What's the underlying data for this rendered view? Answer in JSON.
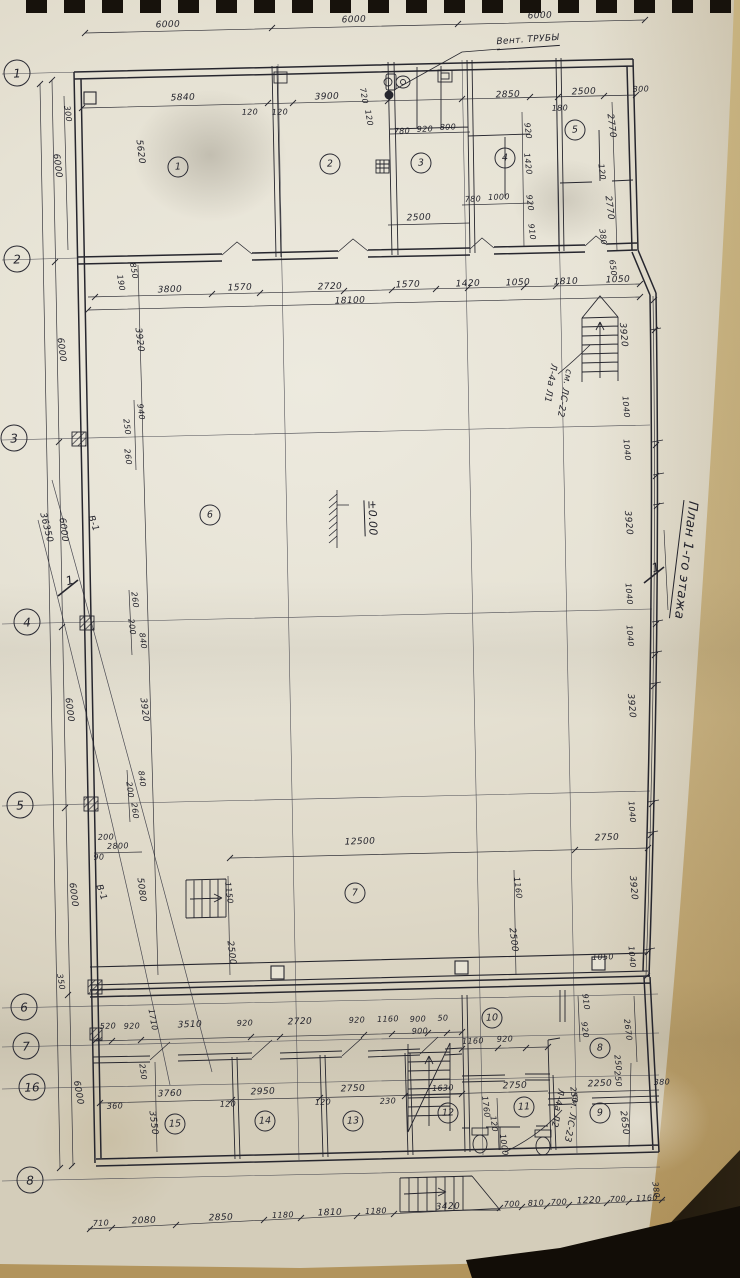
{
  "sheet": {
    "title": "План 1-го этажа"
  },
  "annotations": {
    "vent_pipes": "Вент. ТРУБЫ",
    "stair_top": [
      "Л-4а Л1",
      "см. ЛС-22"
    ],
    "stair_bottom": [
      "Л-4а Л2",
      "см. ЛС-23"
    ],
    "level_mark": "±0.00",
    "section_mark": "1",
    "wall_mark": "В-1"
  },
  "colors": {
    "ink": "#26262e",
    "paper": "#e6e2d4",
    "backing": "#1a140b",
    "second_sheet": "#cdb787"
  },
  "grid_axes": [
    {
      "n": "1",
      "x": 17,
      "y": 73
    },
    {
      "n": "2",
      "x": 17,
      "y": 259
    },
    {
      "n": "3",
      "x": 14,
      "y": 438
    },
    {
      "n": "4",
      "x": 27,
      "y": 622
    },
    {
      "n": "5",
      "x": 20,
      "y": 805
    },
    {
      "n": "6",
      "x": 24,
      "y": 1007
    },
    {
      "n": "7",
      "x": 26,
      "y": 1046
    },
    {
      "n": "16",
      "x": 32,
      "y": 1087
    },
    {
      "n": "8",
      "x": 30,
      "y": 1180
    }
  ],
  "rooms": [
    {
      "n": "1",
      "x": 178,
      "y": 167
    },
    {
      "n": "2",
      "x": 330,
      "y": 164
    },
    {
      "n": "3",
      "x": 421,
      "y": 163
    },
    {
      "n": "4",
      "x": 505,
      "y": 158
    },
    {
      "n": "5",
      "x": 575,
      "y": 130
    },
    {
      "n": "6",
      "x": 210,
      "y": 515
    },
    {
      "n": "7",
      "x": 355,
      "y": 893
    },
    {
      "n": "8",
      "x": 600,
      "y": 1048
    },
    {
      "n": "9",
      "x": 600,
      "y": 1113
    },
    {
      "n": "10",
      "x": 492,
      "y": 1018
    },
    {
      "n": "11",
      "x": 524,
      "y": 1107
    },
    {
      "n": "12",
      "x": 448,
      "y": 1113
    },
    {
      "n": "13",
      "x": 353,
      "y": 1121
    },
    {
      "n": "14",
      "x": 265,
      "y": 1121
    },
    {
      "n": "15",
      "x": 175,
      "y": 1124
    }
  ],
  "dim_labels": [
    {
      "t": "6000",
      "x": 168,
      "y": 26
    },
    {
      "t": "6000",
      "x": 354,
      "y": 21
    },
    {
      "t": "6000",
      "x": 540,
      "y": 17
    },
    {
      "t": "Вент. ТРУБЫ",
      "x": 528,
      "y": 42,
      "r": -4,
      "u": 1,
      "n": "vent-pipes-note"
    },
    {
      "t": "5840",
      "x": 183,
      "y": 99
    },
    {
      "t": "120",
      "x": 250,
      "y": 113,
      "fs": 8
    },
    {
      "t": "120",
      "x": 280,
      "y": 113,
      "fs": 8
    },
    {
      "t": "3900",
      "x": 327,
      "y": 98
    },
    {
      "t": "720",
      "x": 363,
      "y": 96,
      "r": 80,
      "fs": 8
    },
    {
      "t": "120",
      "x": 368,
      "y": 118,
      "r": 80,
      "fs": 8
    },
    {
      "t": "2850",
      "x": 508,
      "y": 96
    },
    {
      "t": "180",
      "x": 560,
      "y": 109,
      "fs": 8
    },
    {
      "t": "2500",
      "x": 584,
      "y": 93
    },
    {
      "t": "300",
      "x": 641,
      "y": 90,
      "fs": 8
    },
    {
      "t": "300",
      "x": 67,
      "y": 114,
      "r": 83,
      "fs": 8
    },
    {
      "t": "6000",
      "x": 56,
      "y": 166,
      "r": 83
    },
    {
      "t": "5620",
      "x": 139,
      "y": 152,
      "r": 83
    },
    {
      "t": "780",
      "x": 402,
      "y": 132,
      "fs": 8
    },
    {
      "t": "920",
      "x": 425,
      "y": 130,
      "fs": 8
    },
    {
      "t": "800",
      "x": 448,
      "y": 128,
      "fs": 8
    },
    {
      "t": "920",
      "x": 527,
      "y": 131,
      "r": 83,
      "fs": 8
    },
    {
      "t": "1420",
      "x": 527,
      "y": 164,
      "r": 83,
      "fs": 8
    },
    {
      "t": "920",
      "x": 529,
      "y": 203,
      "r": 83,
      "fs": 8
    },
    {
      "t": "910",
      "x": 531,
      "y": 232,
      "r": 83,
      "fs": 8
    },
    {
      "t": "780",
      "x": 473,
      "y": 200,
      "fs": 8
    },
    {
      "t": "1000",
      "x": 499,
      "y": 198,
      "fs": 8
    },
    {
      "t": "2500",
      "x": 419,
      "y": 219
    },
    {
      "t": "2770",
      "x": 610,
      "y": 126,
      "r": 83
    },
    {
      "t": "120",
      "x": 601,
      "y": 172,
      "r": 83,
      "fs": 8
    },
    {
      "t": "2770",
      "x": 608,
      "y": 208,
      "r": 83
    },
    {
      "t": "380",
      "x": 602,
      "y": 237,
      "r": 83,
      "fs": 8
    },
    {
      "t": "650",
      "x": 612,
      "y": 268,
      "r": 83,
      "fs": 8
    },
    {
      "t": "3800",
      "x": 170,
      "y": 291
    },
    {
      "t": "1570",
      "x": 240,
      "y": 289
    },
    {
      "t": "2720",
      "x": 330,
      "y": 288
    },
    {
      "t": "1570",
      "x": 408,
      "y": 286
    },
    {
      "t": "1420",
      "x": 468,
      "y": 285
    },
    {
      "t": "1050",
      "x": 518,
      "y": 284
    },
    {
      "t": "1810",
      "x": 566,
      "y": 283
    },
    {
      "t": "1050",
      "x": 618,
      "y": 281
    },
    {
      "t": "18100",
      "x": 350,
      "y": 302
    },
    {
      "t": "850",
      "x": 133,
      "y": 271,
      "r": 80,
      "fs": 8
    },
    {
      "t": "190",
      "x": 120,
      "y": 283,
      "r": 80,
      "fs": 8
    },
    {
      "t": "6000",
      "x": 60,
      "y": 350,
      "r": 83
    },
    {
      "t": "3920",
      "x": 138,
      "y": 340,
      "r": 83
    },
    {
      "t": "36350",
      "x": 45,
      "y": 528,
      "r": 76
    },
    {
      "t": "6000",
      "x": 62,
      "y": 530,
      "r": 83
    },
    {
      "t": "В-1",
      "x": 92,
      "y": 524,
      "r": 70,
      "n": "wall-mark"
    },
    {
      "t": "6000",
      "x": 68,
      "y": 710,
      "r": 83
    },
    {
      "t": "3920",
      "x": 143,
      "y": 710,
      "r": 83
    },
    {
      "t": "6000",
      "x": 72,
      "y": 895,
      "r": 83
    },
    {
      "t": "5080",
      "x": 140,
      "y": 890,
      "r": 83
    },
    {
      "t": "В-1",
      "x": 100,
      "y": 893,
      "r": 70,
      "n": "wall-mark"
    },
    {
      "t": "350",
      "x": 60,
      "y": 982,
      "r": 80,
      "fs": 8
    },
    {
      "t": "6000",
      "x": 77,
      "y": 1093,
      "r": 80
    },
    {
      "t": "940",
      "x": 140,
      "y": 412,
      "r": 83,
      "fs": 8
    },
    {
      "t": "250",
      "x": 126,
      "y": 427,
      "r": 83,
      "fs": 8
    },
    {
      "t": "260",
      "x": 127,
      "y": 457,
      "r": 83,
      "fs": 8
    },
    {
      "t": "260",
      "x": 134,
      "y": 600,
      "r": 83,
      "fs": 8
    },
    {
      "t": "200",
      "x": 131,
      "y": 627,
      "r": 83,
      "fs": 8
    },
    {
      "t": "840",
      "x": 142,
      "y": 641,
      "r": 83,
      "fs": 8
    },
    {
      "t": "840",
      "x": 141,
      "y": 779,
      "r": 83,
      "fs": 8
    },
    {
      "t": "200",
      "x": 129,
      "y": 790,
      "r": 83,
      "fs": 8
    },
    {
      "t": "260",
      "x": 134,
      "y": 811,
      "r": 83,
      "fs": 8
    },
    {
      "t": "200",
      "x": 106,
      "y": 838,
      "fs": 8
    },
    {
      "t": "2800",
      "x": 118,
      "y": 847,
      "fs": 8
    },
    {
      "t": "90",
      "x": 99,
      "y": 858,
      "fs": 8
    },
    {
      "t": "±0.00",
      "x": 371,
      "y": 518,
      "r": 88,
      "u": 1,
      "fs": 11,
      "n": "level-mark"
    },
    {
      "t": "12500",
      "x": 360,
      "y": 843
    },
    {
      "t": "2750",
      "x": 607,
      "y": 839
    },
    {
      "t": "1150",
      "x": 228,
      "y": 893,
      "r": 83,
      "fs": 8
    },
    {
      "t": "2500",
      "x": 230,
      "y": 953,
      "r": 83
    },
    {
      "t": "1160",
      "x": 517,
      "y": 888,
      "r": 83,
      "fs": 8
    },
    {
      "t": "2500",
      "x": 512,
      "y": 940,
      "r": 83
    },
    {
      "t": "3920",
      "x": 622,
      "y": 335,
      "r": 85
    },
    {
      "t": "1040",
      "x": 625,
      "y": 407,
      "r": 85,
      "fs": 8
    },
    {
      "t": "1040",
      "x": 626,
      "y": 450,
      "r": 85,
      "fs": 8
    },
    {
      "t": "3920",
      "x": 627,
      "y": 523,
      "r": 85
    },
    {
      "t": "1040",
      "x": 628,
      "y": 594,
      "r": 85,
      "fs": 8
    },
    {
      "t": "1040",
      "x": 629,
      "y": 636,
      "r": 85,
      "fs": 8
    },
    {
      "t": "3920",
      "x": 630,
      "y": 706,
      "r": 85
    },
    {
      "t": "1040",
      "x": 631,
      "y": 812,
      "r": 85,
      "fs": 8
    },
    {
      "t": "3920",
      "x": 632,
      "y": 888,
      "r": 85
    },
    {
      "t": "1040",
      "x": 631,
      "y": 957,
      "r": 85,
      "fs": 8
    },
    {
      "t": "1050",
      "x": 603,
      "y": 958,
      "fs": 8
    },
    {
      "t": "Л-4а Л1",
      "x": 549,
      "y": 383,
      "r": 100,
      "n": "stair-note"
    },
    {
      "t": "см. ЛС-22",
      "x": 563,
      "y": 393,
      "r": 100,
      "n": "stair-note"
    },
    {
      "t": "Л-4а Л2",
      "x": 556,
      "y": 1108,
      "r": 100,
      "n": "stair-note"
    },
    {
      "t": "см. ЛС-23",
      "x": 570,
      "y": 1118,
      "r": 100,
      "n": "stair-note"
    },
    {
      "t": "План 1-го этажа",
      "x": 684,
      "y": 560,
      "r": 97,
      "u": 1,
      "fs": 13,
      "n": "sheet-title"
    },
    {
      "t": "1",
      "x": 70,
      "y": 581,
      "r": -15,
      "fs": 12,
      "n": "section-mark"
    },
    {
      "t": "1",
      "x": 656,
      "y": 568,
      "r": -15,
      "fs": 12,
      "n": "section-mark"
    },
    {
      "t": "520",
      "x": 108,
      "y": 1027,
      "fs": 8
    },
    {
      "t": "920",
      "x": 132,
      "y": 1027,
      "fs": 8
    },
    {
      "t": "1710",
      "x": 152,
      "y": 1020,
      "r": 80,
      "fs": 8
    },
    {
      "t": "3510",
      "x": 190,
      "y": 1026
    },
    {
      "t": "920",
      "x": 245,
      "y": 1024,
      "fs": 8
    },
    {
      "t": "2720",
      "x": 300,
      "y": 1023
    },
    {
      "t": "920",
      "x": 357,
      "y": 1021,
      "fs": 8
    },
    {
      "t": "1160",
      "x": 388,
      "y": 1020,
      "fs": 8
    },
    {
      "t": "900",
      "x": 418,
      "y": 1020,
      "fs": 8
    },
    {
      "t": "50",
      "x": 443,
      "y": 1019,
      "fs": 8
    },
    {
      "t": "900",
      "x": 420,
      "y": 1032,
      "fs": 8
    },
    {
      "t": "910",
      "x": 585,
      "y": 1002,
      "r": 83,
      "fs": 8
    },
    {
      "t": "920",
      "x": 584,
      "y": 1030,
      "r": 83,
      "fs": 8
    },
    {
      "t": "2670",
      "x": 627,
      "y": 1030,
      "r": 83,
      "fs": 8
    },
    {
      "t": "1160",
      "x": 473,
      "y": 1042,
      "fs": 8
    },
    {
      "t": "920",
      "x": 505,
      "y": 1040,
      "fs": 8
    },
    {
      "t": "2750",
      "x": 515,
      "y": 1087
    },
    {
      "t": "1630",
      "x": 443,
      "y": 1089,
      "fs": 8
    },
    {
      "t": "2250",
      "x": 600,
      "y": 1085
    },
    {
      "t": "380",
      "x": 662,
      "y": 1083,
      "fs": 8
    },
    {
      "t": "250",
      "x": 573,
      "y": 1095,
      "r": 83,
      "fs": 8
    },
    {
      "t": "250",
      "x": 617,
      "y": 1063,
      "r": 83,
      "fs": 8
    },
    {
      "t": "250",
      "x": 617,
      "y": 1079,
      "r": 83,
      "fs": 8
    },
    {
      "t": "2650",
      "x": 623,
      "y": 1123,
      "r": 83
    },
    {
      "t": "380",
      "x": 655,
      "y": 1190,
      "r": 83,
      "fs": 8
    },
    {
      "t": "1760",
      "x": 485,
      "y": 1107,
      "r": 83,
      "fs": 8
    },
    {
      "t": "120",
      "x": 493,
      "y": 1124,
      "r": 83,
      "fs": 8
    },
    {
      "t": "1000",
      "x": 503,
      "y": 1145,
      "r": 83,
      "fs": 8
    },
    {
      "t": "3760",
      "x": 170,
      "y": 1095
    },
    {
      "t": "2950",
      "x": 263,
      "y": 1093
    },
    {
      "t": "2750",
      "x": 353,
      "y": 1090
    },
    {
      "t": "120",
      "x": 228,
      "y": 1105,
      "fs": 8
    },
    {
      "t": "120",
      "x": 323,
      "y": 1103,
      "fs": 8
    },
    {
      "t": "230",
      "x": 388,
      "y": 1102,
      "fs": 8
    },
    {
      "t": "360",
      "x": 115,
      "y": 1107,
      "fs": 8
    },
    {
      "t": "3550",
      "x": 152,
      "y": 1123,
      "r": 83
    },
    {
      "t": "250",
      "x": 142,
      "y": 1072,
      "r": 83,
      "fs": 8
    },
    {
      "t": "710",
      "x": 101,
      "y": 1224,
      "fs": 8
    },
    {
      "t": "2080",
      "x": 144,
      "y": 1222
    },
    {
      "t": "2850",
      "x": 221,
      "y": 1219
    },
    {
      "t": "1180",
      "x": 283,
      "y": 1216,
      "fs": 8
    },
    {
      "t": "1810",
      "x": 330,
      "y": 1214
    },
    {
      "t": "1180",
      "x": 376,
      "y": 1212,
      "fs": 8
    },
    {
      "t": "3420",
      "x": 448,
      "y": 1208
    },
    {
      "t": "700",
      "x": 512,
      "y": 1205,
      "fs": 8
    },
    {
      "t": "810",
      "x": 536,
      "y": 1204,
      "fs": 8
    },
    {
      "t": "700",
      "x": 559,
      "y": 1203,
      "fs": 8
    },
    {
      "t": "1220",
      "x": 589,
      "y": 1202
    },
    {
      "t": "700",
      "x": 618,
      "y": 1200,
      "fs": 8
    },
    {
      "t": "1160",
      "x": 647,
      "y": 1199,
      "fs": 8
    }
  ]
}
